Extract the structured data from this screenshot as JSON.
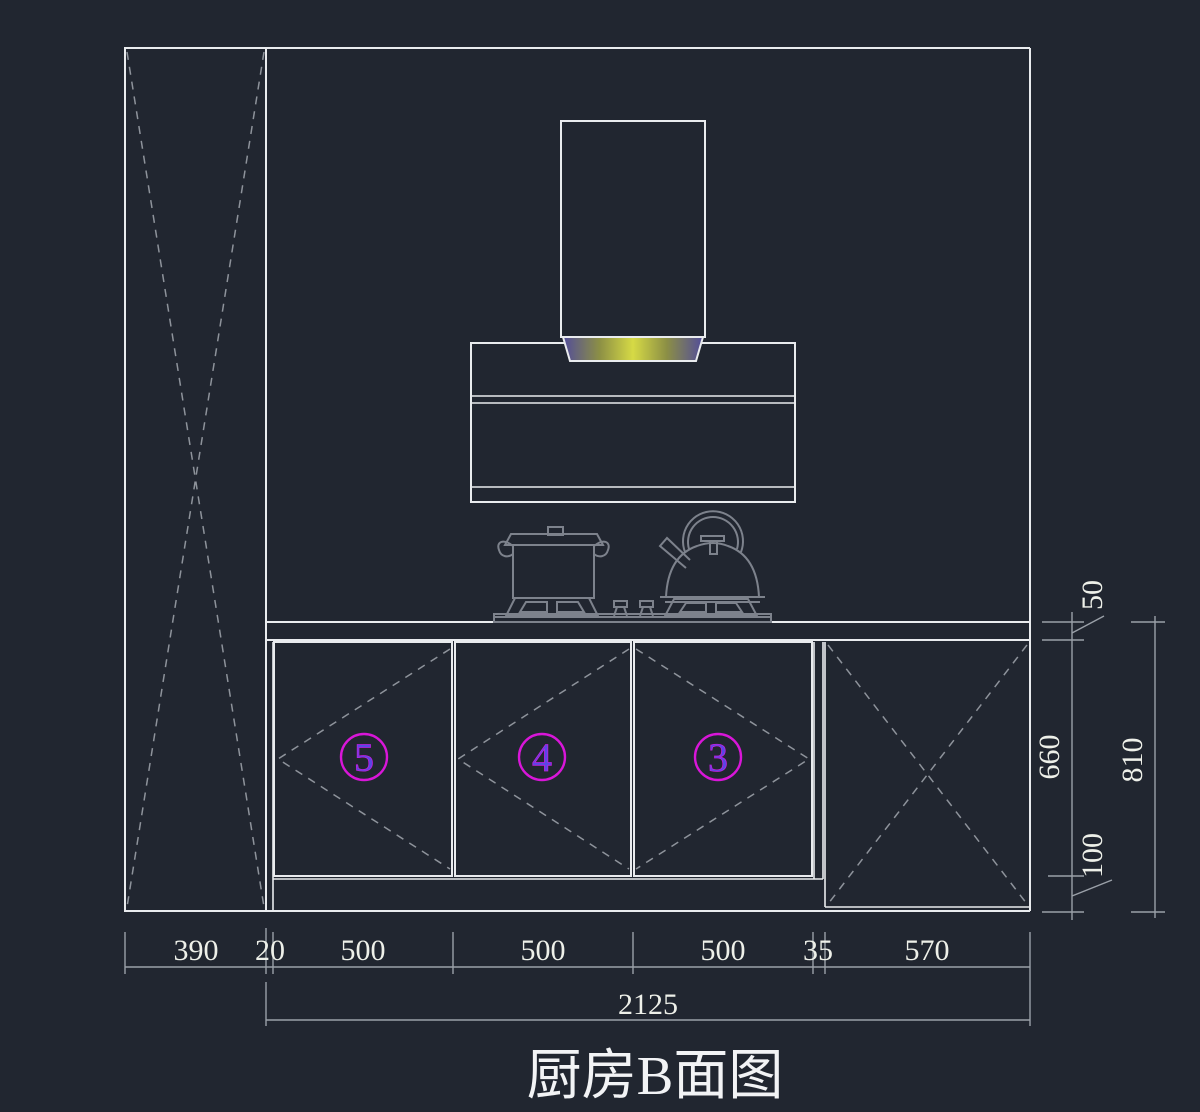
{
  "drawing": {
    "title": "厨房B面图",
    "dim_bottom": {
      "segments": [
        {
          "label": "390"
        },
        {
          "label": "20"
        },
        {
          "label": "500"
        },
        {
          "label": "500"
        },
        {
          "label": "500"
        },
        {
          "label": "35"
        },
        {
          "label": "570"
        }
      ],
      "total": {
        "label": "2125"
      }
    },
    "dim_right": {
      "countertop_thickness": {
        "label": "50"
      },
      "door_height": {
        "label": "660"
      },
      "toe_kick": {
        "label": "100"
      },
      "overall": {
        "label": "810"
      }
    },
    "door_tags": [
      {
        "number": "5"
      },
      {
        "number": "4"
      },
      {
        "number": "3"
      }
    ],
    "colors": {
      "background": "#212630",
      "line_white": "#e9ebee",
      "line_gray": "#7d828c",
      "dash_gray": "#8e939b",
      "dim_gray": "#9aa0a8",
      "dim_text": "#eef0e9",
      "tag_circle_magenta": "#d916d9",
      "tag_digit_blue": "#5a46e6",
      "hood_glow_center": "#d6da45",
      "hood_glow_mid": "#8c8f45",
      "hood_glow_edge": "#524d9a"
    }
  }
}
